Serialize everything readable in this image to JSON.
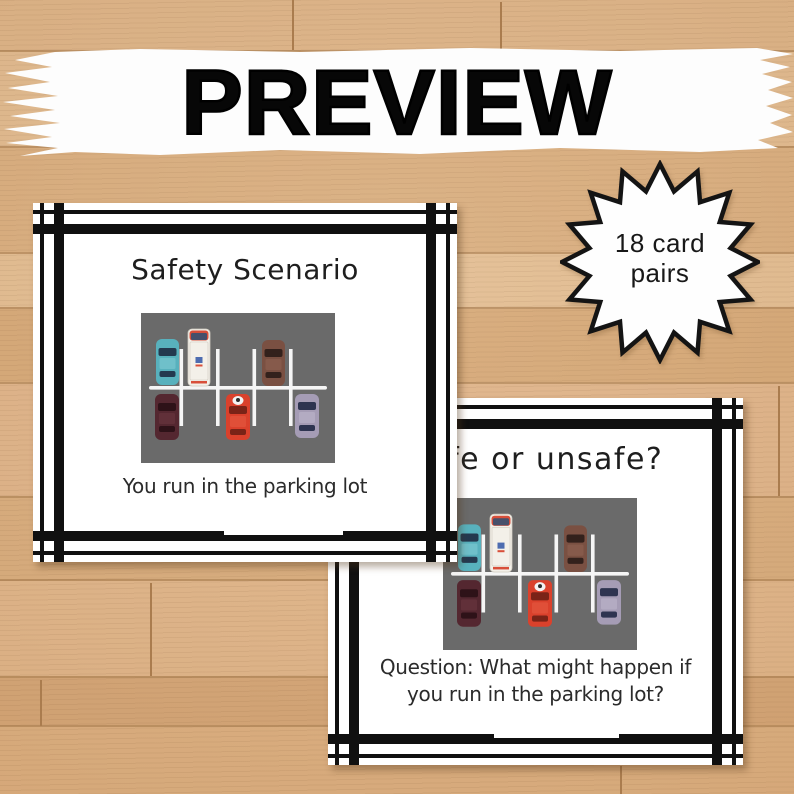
{
  "banner": {
    "title": "PREVIEW"
  },
  "badge": {
    "lines": [
      "18 card",
      "pairs"
    ]
  },
  "cards": [
    {
      "title": "Safety Scenario",
      "caption_lines": [
        "You run in the parking lot"
      ]
    },
    {
      "title": "Safe or unsafe?",
      "caption_lines": [
        "Question: What might happen if",
        "you run in the parking lot?"
      ]
    }
  ],
  "colors": {
    "ink": "#101010",
    "card_bg": "#ffffff",
    "banner_bg": "#fdfdfd",
    "wood_base": "#dcae7e",
    "text": "#2b2b2b"
  },
  "parking_lot": {
    "asphalt": "#6a6a6a",
    "line_color": "#f5f5f5",
    "cars": {
      "teal": {
        "body": "#58b1bd",
        "glass": "#24394f",
        "roof": "#6fc0ca"
      },
      "van": {
        "body": "#f3f0e9",
        "glass": "#47506b",
        "trim": "#d84f3a",
        "accent": "#4d6cb0",
        "outline": "#cfcabf"
      },
      "brown": {
        "body": "#7a5042",
        "glass": "#33211c",
        "roof": "#865a4b"
      },
      "maroon": {
        "body": "#542730",
        "glass": "#2e1218",
        "roof": "#613039"
      },
      "red": {
        "body": "#da412c",
        "glass": "#7a2317",
        "roof": "#e04f38",
        "figure": "#f2f2f2",
        "figure_head": "#2b2b2b"
      },
      "purple": {
        "body": "#a59cb5",
        "glass": "#2e3450",
        "roof": "#b3abc2"
      }
    }
  }
}
